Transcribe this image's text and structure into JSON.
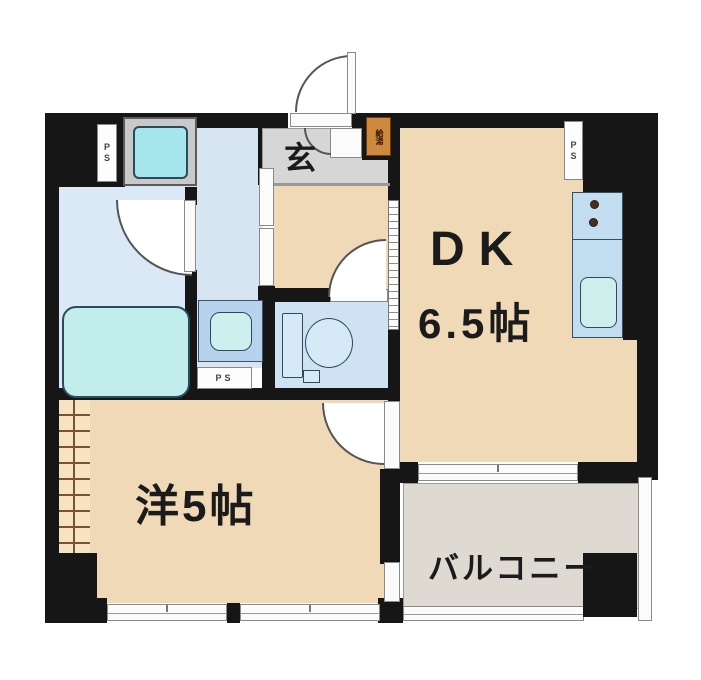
{
  "floorplan": {
    "labels": {
      "entrance": "玄",
      "dk_name": "DK",
      "dk_size": "6.5帖",
      "western_room": "洋5帖",
      "balcony": "バルコニー",
      "pipe_space": "PS",
      "water_heater": "給湯"
    },
    "colors": {
      "wall": "#161616",
      "room_floor": "#f0d9b6",
      "wet_floor": "#dbe8f5",
      "toilet_floor": "#cfe2f3",
      "genkan_floor": "#d6d6d6",
      "balcony_floor": "#ded9d1",
      "fixture_cyan": "#c2eded",
      "kitchen_counter": "#c3ddf0",
      "water_heater_box": "#cd8a3e"
    }
  }
}
